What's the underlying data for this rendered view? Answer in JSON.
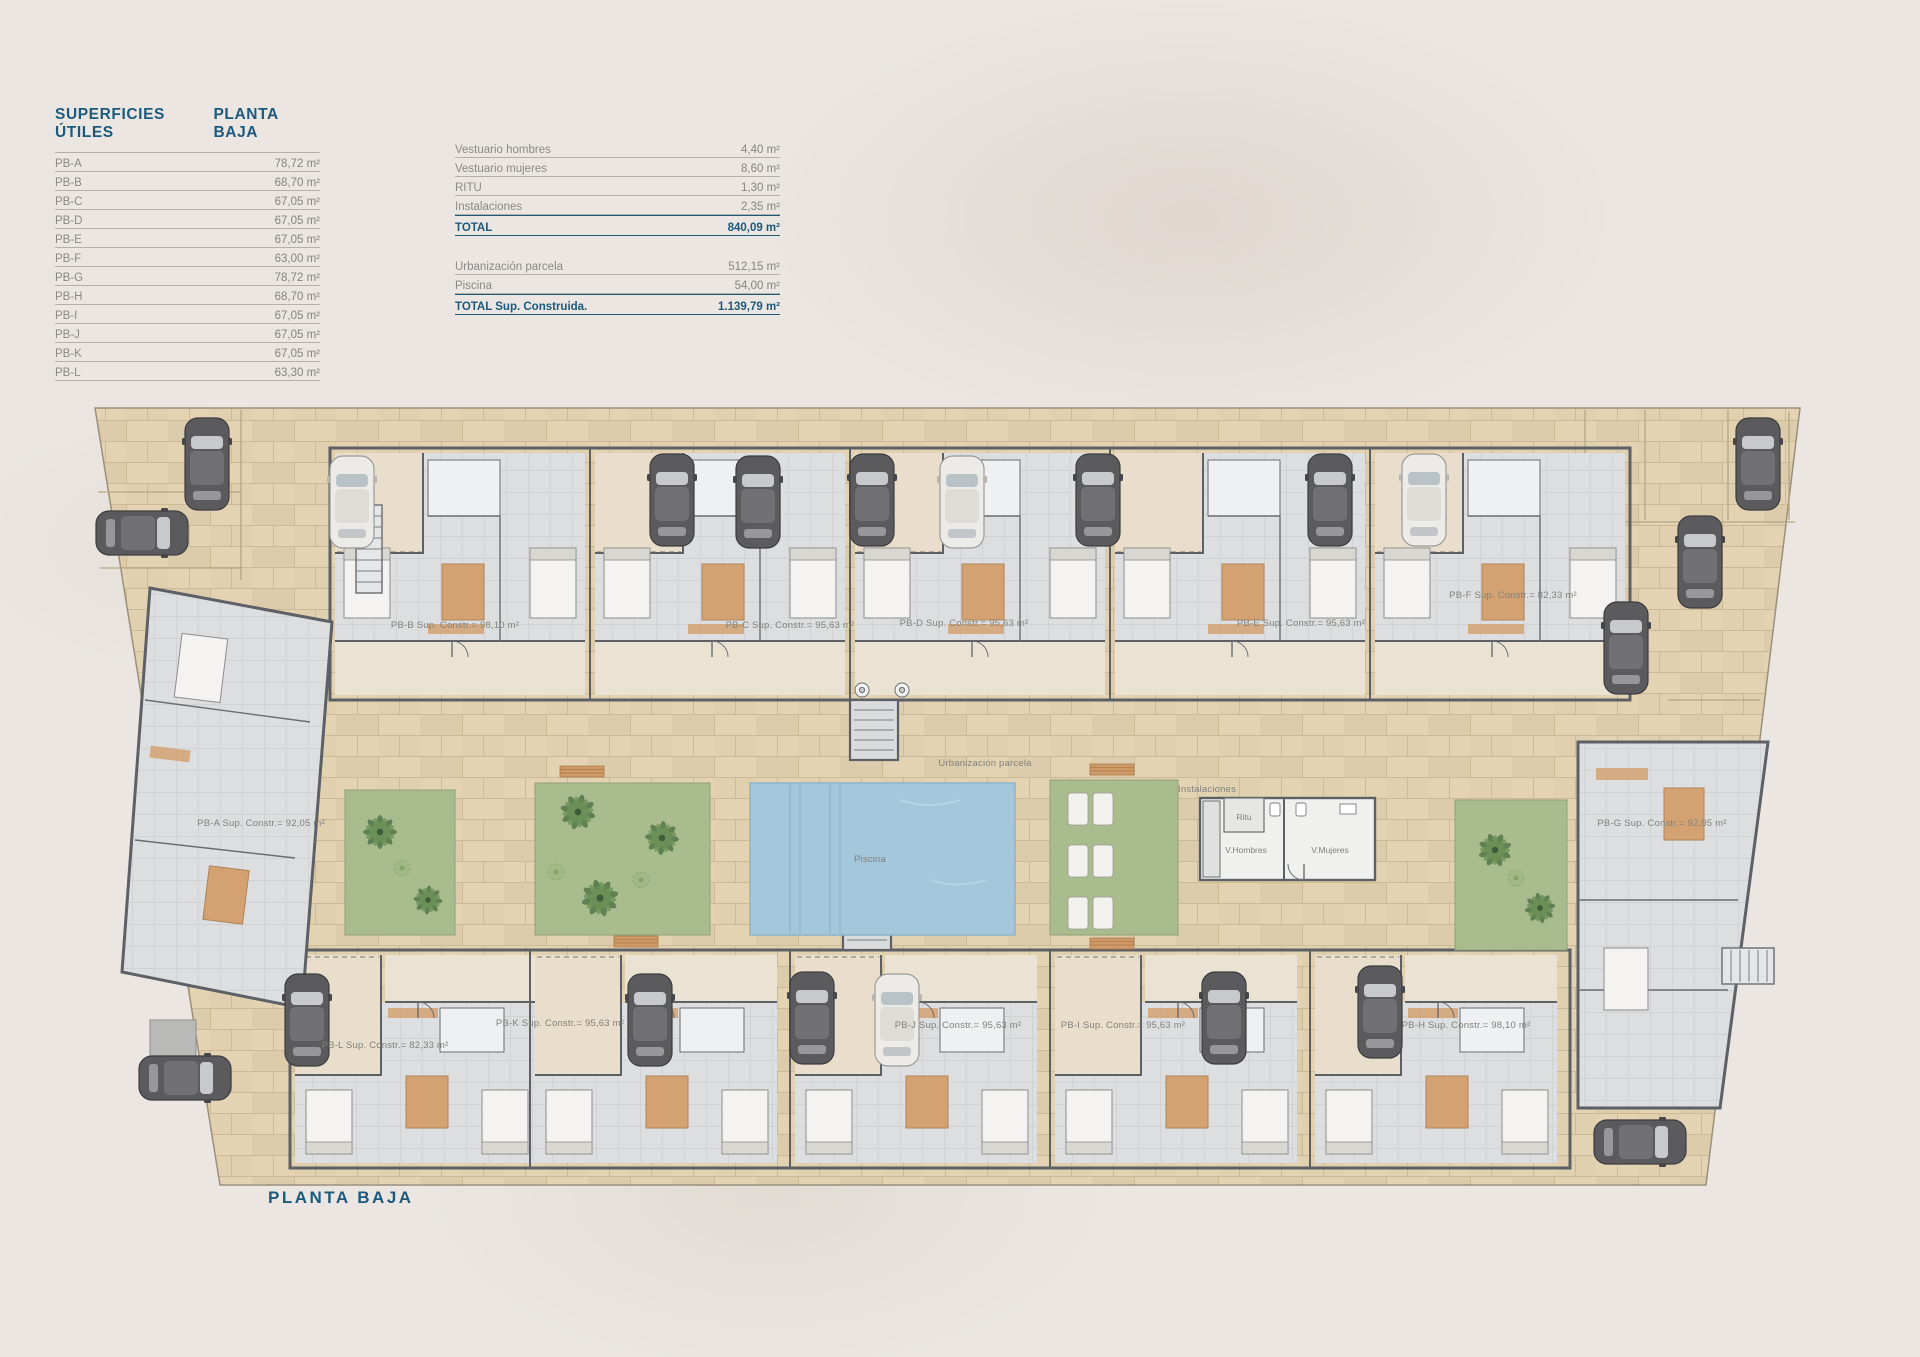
{
  "page": {
    "caption": "PLANTA BAJA"
  },
  "surfaces_table": {
    "title": "SUPERFICIES ÚTILES",
    "subtitle": "PLANTA BAJA",
    "rows": [
      {
        "label": "PB-A",
        "value": "78,72 m²"
      },
      {
        "label": "PB-B",
        "value": "68,70 m²"
      },
      {
        "label": "PB-C",
        "value": "67,05 m²"
      },
      {
        "label": "PB-D",
        "value": "67,05 m²"
      },
      {
        "label": "PB-E",
        "value": "67,05 m²"
      },
      {
        "label": "PB-F",
        "value": "63,00 m²"
      },
      {
        "label": "PB-G",
        "value": "78,72 m²"
      },
      {
        "label": "PB-H",
        "value": "68,70 m²"
      },
      {
        "label": "PB-I",
        "value": "67,05 m²"
      },
      {
        "label": "PB-J",
        "value": "67,05 m²"
      },
      {
        "label": "PB-K",
        "value": "67,05 m²"
      },
      {
        "label": "PB-L",
        "value": "63,30 m²"
      }
    ]
  },
  "summary_table": {
    "rows": [
      {
        "label": "Vestuario hombres",
        "value": "4,40 m²"
      },
      {
        "label": "Vestuario mujeres",
        "value": "8,60 m²"
      },
      {
        "label": "RITU",
        "value": "1,30 m²"
      },
      {
        "label": "Instalaciones",
        "value": "2,35 m²"
      }
    ],
    "total": {
      "label": "TOTAL",
      "value": "840,09 m²"
    },
    "rows2": [
      {
        "label": "Urbanización parcela",
        "value": "512,15 m²"
      },
      {
        "label": "Piscina",
        "value": "54,00 m²"
      }
    ],
    "total2": {
      "label": "TOTAL Sup. Construida.",
      "value": "1.139,79 m²"
    }
  },
  "plan": {
    "units": [
      {
        "id": "PB-A",
        "label": "PB-A Sup. Constr.= 92,05 m²"
      },
      {
        "id": "PB-B",
        "label": "PB-B Sup. Constr.= 98,10 m²"
      },
      {
        "id": "PB-C",
        "label": "PB-C Sup. Constr.= 95,63 m²"
      },
      {
        "id": "PB-D",
        "label": "PB-D Sup. Constr.= 95,63 m²"
      },
      {
        "id": "PB-E",
        "label": "PB-E Sup. Constr.= 95,63 m²"
      },
      {
        "id": "PB-F",
        "label": "PB-F Sup. Constr.= 82,33 m²"
      },
      {
        "id": "PB-G",
        "label": "PB-G Sup. Constr.= 92,05 m²"
      },
      {
        "id": "PB-H",
        "label": "PB-H Sup. Constr.= 98,10 m²"
      },
      {
        "id": "PB-I",
        "label": "PB-I Sup. Constr.= 95,63 m²"
      },
      {
        "id": "PB-J",
        "label": "PB-J Sup. Constr.= 95,63 m²"
      },
      {
        "id": "PB-K",
        "label": "PB-K Sup. Constr.= 95,63 m²"
      },
      {
        "id": "PB-L",
        "label": "PB-L Sup. Constr.= 82,33 m²"
      }
    ],
    "labels": {
      "urbanizacion": "Urbanización parcela",
      "piscina": "Piscina",
      "instalaciones": "Instalaciones",
      "ritu": "Ritu",
      "v_hombres": "V.Hombres",
      "v_mujeres": "V.Mujeres"
    },
    "colors": {
      "heading": "#1c5a7d",
      "paving": "#e3d3b3",
      "building_floor": "#d9dbdd",
      "wall": "#5d6065",
      "garden": "#a9bc8e",
      "pool": "#a5c7dc",
      "terracotta": "#d4a272"
    },
    "cars": [
      {
        "x": 207,
        "y": 464,
        "r": 0,
        "v": "dark"
      },
      {
        "x": 352,
        "y": 502,
        "r": 0,
        "v": "light"
      },
      {
        "x": 672,
        "y": 500,
        "r": 0,
        "v": "dark"
      },
      {
        "x": 758,
        "y": 502,
        "r": 0,
        "v": "dark"
      },
      {
        "x": 872,
        "y": 500,
        "r": 0,
        "v": "dark"
      },
      {
        "x": 962,
        "y": 502,
        "r": 0,
        "v": "light"
      },
      {
        "x": 1098,
        "y": 500,
        "r": 0,
        "v": "dark"
      },
      {
        "x": 1330,
        "y": 500,
        "r": 0,
        "v": "dark"
      },
      {
        "x": 1424,
        "y": 500,
        "r": 0,
        "v": "light"
      },
      {
        "x": 1758,
        "y": 464,
        "r": 0,
        "v": "dark"
      },
      {
        "x": 1700,
        "y": 562,
        "r": 0,
        "v": "dark"
      },
      {
        "x": 1626,
        "y": 648,
        "r": 0,
        "v": "dark"
      },
      {
        "x": 142,
        "y": 533,
        "r": 90,
        "v": "dark"
      },
      {
        "x": 307,
        "y": 1020,
        "r": 0,
        "v": "dark"
      },
      {
        "x": 650,
        "y": 1020,
        "r": 0,
        "v": "dark"
      },
      {
        "x": 812,
        "y": 1018,
        "r": 0,
        "v": "dark"
      },
      {
        "x": 897,
        "y": 1020,
        "r": 0,
        "v": "light"
      },
      {
        "x": 1224,
        "y": 1018,
        "r": 0,
        "v": "dark"
      },
      {
        "x": 1380,
        "y": 1012,
        "r": 0,
        "v": "dark"
      },
      {
        "x": 185,
        "y": 1078,
        "r": 90,
        "v": "dark"
      },
      {
        "x": 1640,
        "y": 1142,
        "r": 90,
        "v": "dark"
      }
    ],
    "palms": [
      {
        "x": 380,
        "y": 832,
        "s": 1.0,
        "r": 0
      },
      {
        "x": 428,
        "y": 900,
        "s": 0.85,
        "r": 50
      },
      {
        "x": 578,
        "y": 812,
        "s": 1.05,
        "r": 15
      },
      {
        "x": 662,
        "y": 838,
        "s": 1.0,
        "r": -40
      },
      {
        "x": 600,
        "y": 898,
        "s": 1.1,
        "r": 75
      },
      {
        "x": 1495,
        "y": 850,
        "s": 1.0,
        "r": 25
      },
      {
        "x": 1540,
        "y": 908,
        "s": 0.9,
        "r": -55
      }
    ],
    "bushes": [
      {
        "x": 402,
        "y": 868
      },
      {
        "x": 641,
        "y": 880
      },
      {
        "x": 1516,
        "y": 878
      },
      {
        "x": 556,
        "y": 872
      }
    ]
  }
}
